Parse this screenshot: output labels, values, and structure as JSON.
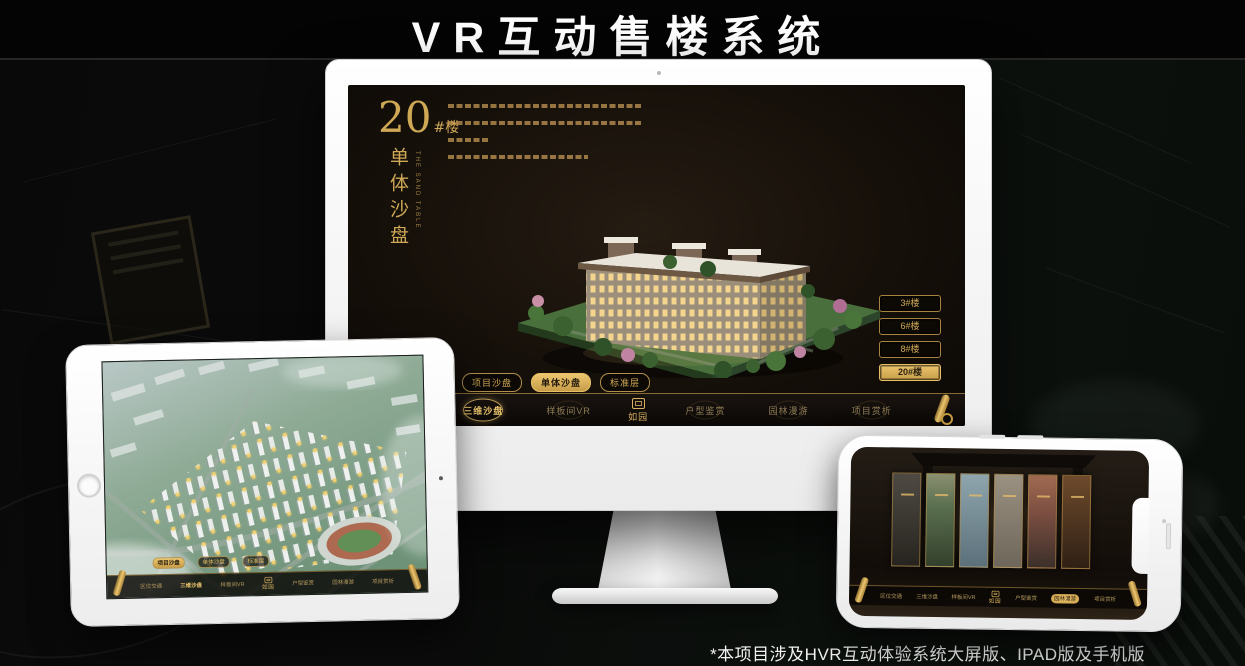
{
  "page": {
    "title": "VR互动售楼系统",
    "footnote": "*本项目涉及HVR互动体验系统大屏版、IPAD版及手机版"
  },
  "colors": {
    "gold": "#cfa855",
    "gold_active": "#ecc76f",
    "screen_dark": "#16100a",
    "device_white": "#ffffff"
  },
  "monitor_app": {
    "unit_number": "20",
    "unit_suffix": "#楼",
    "unit_subtitle": "单体沙盘",
    "unit_subtitle_en": "THE SAND TABLE",
    "floor_buttons": [
      {
        "label": "3#楼"
      },
      {
        "label": "6#楼"
      },
      {
        "label": "8#楼"
      },
      {
        "label": "20#楼"
      }
    ],
    "active_floor": "20#楼",
    "sub_tabs": [
      {
        "label": "项目沙盘"
      },
      {
        "label": "单体沙盘"
      },
      {
        "label": "标准层"
      }
    ],
    "active_sub_tab": "单体沙盘",
    "nav": {
      "items_left": [
        {
          "label": "区位交通"
        },
        {
          "label": "三维沙盘"
        },
        {
          "label": "样板间VR"
        }
      ],
      "logo_text": "如园",
      "items_right": [
        {
          "label": "户型鉴赏"
        },
        {
          "label": "园林漫游"
        },
        {
          "label": "项目赏析"
        }
      ],
      "active_item": "三维沙盘"
    }
  },
  "tablet_app": {
    "sub_tabs": [
      {
        "label": "项目沙盘"
      },
      {
        "label": "单体沙盘"
      },
      {
        "label": "标准层"
      }
    ],
    "active_sub_tab": "项目沙盘",
    "nav": {
      "items_left": [
        {
          "label": "区位交通"
        },
        {
          "label": "三维沙盘"
        },
        {
          "label": "样板间VR"
        }
      ],
      "logo_text": "如园",
      "items_right": [
        {
          "label": "户型鉴赏"
        },
        {
          "label": "园林漫游"
        },
        {
          "label": "项目赏析"
        }
      ],
      "active_item": "三维沙盘"
    }
  },
  "phone_app": {
    "nav": {
      "items_left": [
        {
          "label": "区位交通"
        },
        {
          "label": "三维沙盘"
        },
        {
          "label": "样板间VR"
        }
      ],
      "logo_text": "如园",
      "items_right": [
        {
          "label": "户型鉴赏"
        },
        {
          "label": "园林漫游"
        },
        {
          "label": "项目赏析"
        }
      ],
      "active_item": "园林漫游"
    }
  }
}
